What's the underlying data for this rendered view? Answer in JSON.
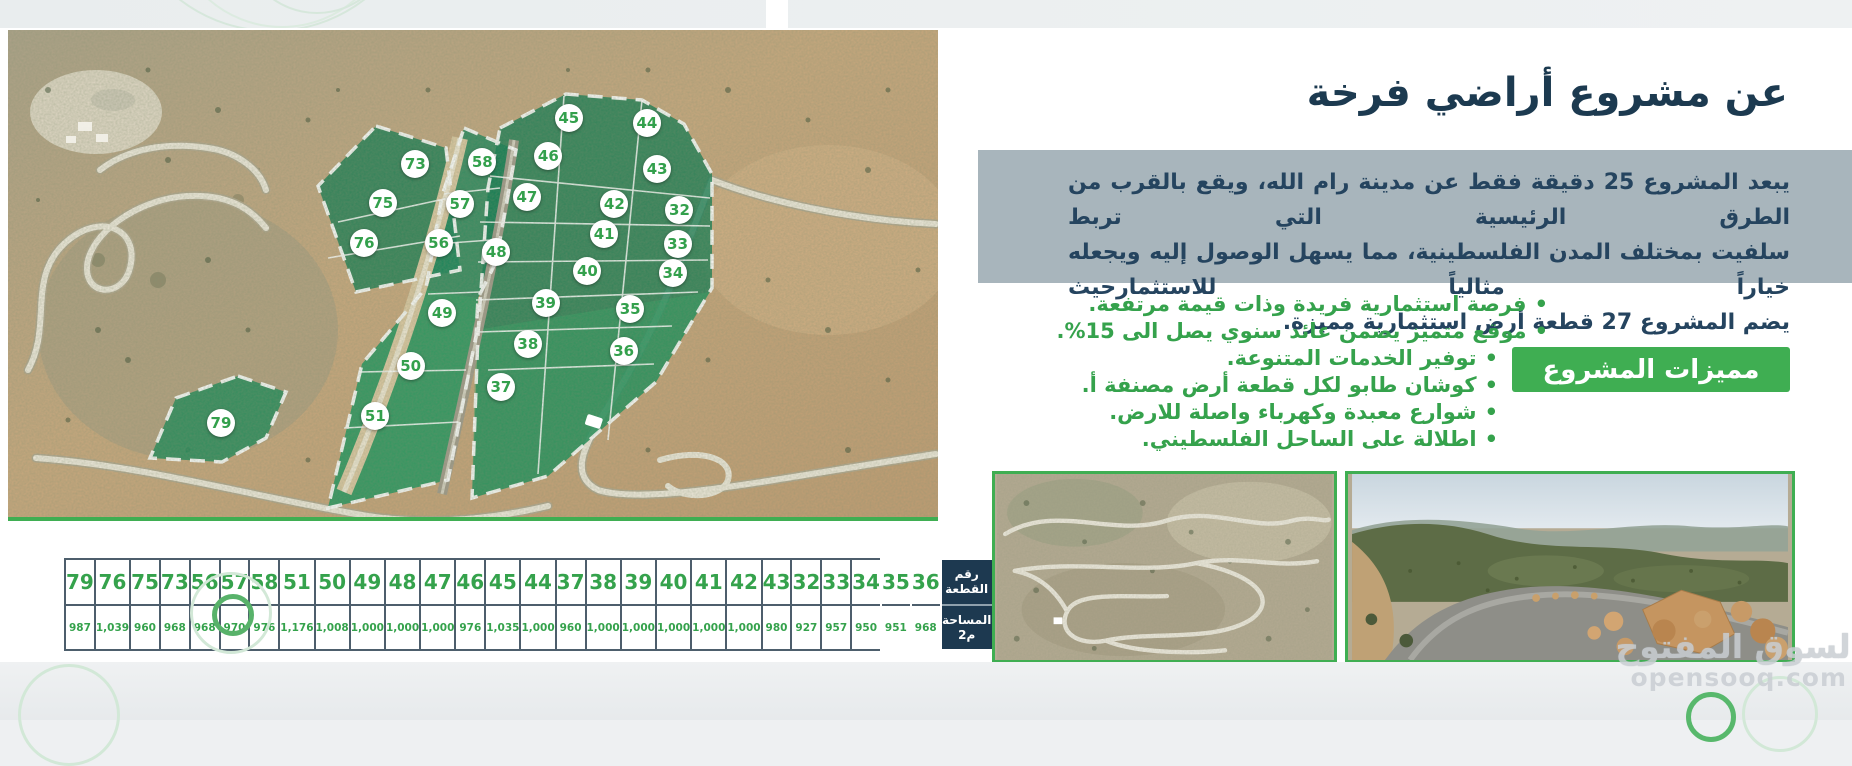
{
  "header": {
    "title": "عن مشروع أراضي فرخة"
  },
  "about": {
    "paragraph_lines": [
      "يبعد المشروع 25 دقيقة فقط عن مدينة رام الله، ويقع بالقرب من الطرق الرئيسية التي تربط",
      "سلفيت بمختلف المدن الفلسطينية، مما يسهل الوصول إليه ويجعله خياراً مثالياً للاستثمارحيث",
      "يضم المشروع 27 قطعة أرض استثمارية مميزة."
    ]
  },
  "features": {
    "banner_label": "مميزات المشروع",
    "items": [
      "فرصة استثمارية فريدة وذات قيمة مرتفعة.",
      "موقع متميز يضمن عائد سنوي يصل الى 15%.",
      "توفير الخدمات المتنوعة.",
      "كوشان طابو لكل قطعة أرض مصنفة أ.",
      "شوارع معبدة وكهرباء واصلة للارض.",
      "اطلالة على الساحل الفلسطيني."
    ]
  },
  "map": {
    "plots": [
      {
        "n": "45",
        "x": 60.3,
        "y": 18.1
      },
      {
        "n": "44",
        "x": 68.7,
        "y": 19.1
      },
      {
        "n": "73",
        "x": 43.8,
        "y": 27.5
      },
      {
        "n": "58",
        "x": 51.0,
        "y": 27.1
      },
      {
        "n": "46",
        "x": 58.1,
        "y": 25.9
      },
      {
        "n": "43",
        "x": 69.8,
        "y": 28.5
      },
      {
        "n": "75",
        "x": 40.3,
        "y": 35.5
      },
      {
        "n": "57",
        "x": 48.6,
        "y": 35.7
      },
      {
        "n": "47",
        "x": 55.8,
        "y": 34.3
      },
      {
        "n": "42",
        "x": 65.2,
        "y": 35.7
      },
      {
        "n": "32",
        "x": 72.2,
        "y": 37.0
      },
      {
        "n": "76",
        "x": 38.3,
        "y": 43.7
      },
      {
        "n": "56",
        "x": 46.3,
        "y": 43.7
      },
      {
        "n": "48",
        "x": 52.5,
        "y": 45.6
      },
      {
        "n": "41",
        "x": 64.1,
        "y": 41.9
      },
      {
        "n": "33",
        "x": 72.0,
        "y": 43.9
      },
      {
        "n": "40",
        "x": 62.3,
        "y": 49.5
      },
      {
        "n": "34",
        "x": 71.5,
        "y": 49.9
      },
      {
        "n": "49",
        "x": 46.7,
        "y": 58.1
      },
      {
        "n": "39",
        "x": 57.8,
        "y": 56.1
      },
      {
        "n": "35",
        "x": 66.9,
        "y": 57.3
      },
      {
        "n": "38",
        "x": 55.9,
        "y": 64.5
      },
      {
        "n": "36",
        "x": 66.2,
        "y": 65.9
      },
      {
        "n": "50",
        "x": 43.3,
        "y": 69.0
      },
      {
        "n": "37",
        "x": 53.0,
        "y": 73.3
      },
      {
        "n": "51",
        "x": 39.5,
        "y": 79.3
      },
      {
        "n": "79",
        "x": 22.9,
        "y": 80.7
      }
    ]
  },
  "table": {
    "row1_header": "رقم القطعة",
    "row2_header": "المساحة م2",
    "columns": [
      {
        "plot": "79",
        "area": "987"
      },
      {
        "plot": "76",
        "area": "1,039"
      },
      {
        "plot": "75",
        "area": "960"
      },
      {
        "plot": "73",
        "area": "968"
      },
      {
        "plot": "56",
        "area": "968"
      },
      {
        "plot": "57",
        "area": "970"
      },
      {
        "plot": "58",
        "area": "976"
      },
      {
        "plot": "51",
        "area": "1,176"
      },
      {
        "plot": "50",
        "area": "1,008"
      },
      {
        "plot": "49",
        "area": "1,000"
      },
      {
        "plot": "48",
        "area": "1,000"
      },
      {
        "plot": "47",
        "area": "1,000"
      },
      {
        "plot": "46",
        "area": "976"
      },
      {
        "plot": "45",
        "area": "1,035"
      },
      {
        "plot": "44",
        "area": "1,000"
      },
      {
        "plot": "37",
        "area": "960"
      },
      {
        "plot": "38",
        "area": "1,000"
      },
      {
        "plot": "39",
        "area": "1,000"
      },
      {
        "plot": "40",
        "area": "1,000"
      },
      {
        "plot": "41",
        "area": "1,000"
      },
      {
        "plot": "42",
        "area": "1,000"
      },
      {
        "plot": "43",
        "area": "980"
      },
      {
        "plot": "32",
        "area": "927"
      },
      {
        "plot": "33",
        "area": "957"
      },
      {
        "plot": "34",
        "area": "950"
      },
      {
        "plot": "35",
        "area": "951"
      },
      {
        "plot": "36",
        "area": "968"
      }
    ]
  },
  "watermark": {
    "brand": "السوق المفتوح",
    "site": "opensooq.com"
  },
  "colors": {
    "accent_green": "#3fae52",
    "navy": "#1d3950",
    "panel_gray": "#a8b5bc",
    "plot_green": "#35a24c"
  }
}
